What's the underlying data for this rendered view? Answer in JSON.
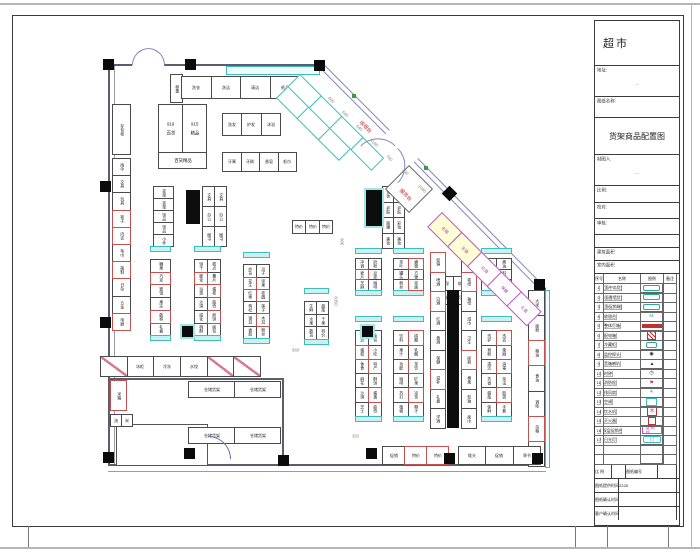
{
  "title_block": {
    "store_name": "超市",
    "address_label": "地址:",
    "address_value": "··",
    "sheet_name_label": "图纸名称:",
    "sheet_title": "货架商品配置图",
    "drafter_label": "制图人:",
    "drafter_value": "···",
    "scale_label": "比例:",
    "check_label": "校对:",
    "audit_label": "审核:",
    "area_label_1": "建筑面积",
    "area_label_2": "室内面积"
  },
  "legend": {
    "headers": [
      "序号",
      "名称",
      "图例",
      "备注"
    ],
    "rows": [
      {
        "no": "1",
        "name": "双面中岛货架",
        "sym": "teal-pill",
        "txt": ""
      },
      {
        "no": "2",
        "name": "单面靠墙货架",
        "sym": "teal-pill",
        "txt": ""
      },
      {
        "no": "3",
        "name": "双面促销端架",
        "sym": "teal-pill",
        "txt": ""
      },
      {
        "no": "4",
        "name": "收银台",
        "sym": "teal-text",
        "txt": "M"
      },
      {
        "no": "5",
        "name": "整体灯箱",
        "sym": "red-bar",
        "txt": ""
      },
      {
        "no": "6",
        "name": "配电箱",
        "sym": "red-box",
        "txt": ""
      },
      {
        "no": "7",
        "name": "冷藏柜",
        "sym": "teal-sm",
        "txt": ""
      },
      {
        "no": "8",
        "name": "监控探头",
        "sym": "cam",
        "txt": "◉"
      },
      {
        "no": "9",
        "name": "音箱喇叭",
        "sym": "tri",
        "txt": "▲"
      },
      {
        "no": "10",
        "name": "时钟",
        "sym": "clock",
        "txt": "◷"
      },
      {
        "no": "11",
        "name": "消防栓",
        "sym": "flag",
        "txt": "⚑"
      },
      {
        "no": "12",
        "name": "排风扇",
        "sym": "fan",
        "txt": "✳"
      },
      {
        "no": "13",
        "name": "空调",
        "sym": "cyan-box",
        "txt": ""
      },
      {
        "no": "14",
        "name": "饮水机",
        "sym": "red-water",
        "txt": "水"
      },
      {
        "no": "15",
        "name": "灭火器",
        "sym": "red-sm",
        "txt": ""
      },
      {
        "no": "16",
        "name": "双层促销台",
        "sym": "mag-box",
        "txt": "促销台"
      },
      {
        "no": "17",
        "name": "日光灯",
        "sym": "cyan-pill",
        "txt": "灯"
      },
      {
        "no": "",
        "name": "",
        "sym": "none",
        "txt": ""
      },
      {
        "no": "",
        "name": "",
        "sym": "none",
        "txt": ""
      }
    ]
  },
  "footer": {
    "row1": [
      "比 例",
      "",
      "图纸编号",
      ""
    ],
    "rows": [
      {
        "label": "图纸提供时间",
        "value": "2228"
      },
      {
        "label": "图纸确认时间",
        "value": ""
      },
      {
        "label": "客户确认时间",
        "value": ""
      }
    ]
  },
  "plan": {
    "labels": {
      "locker": "存包柜",
      "weigh": "称重",
      "cashier": "收银台",
      "service": "服务台"
    },
    "dims": [
      "600",
      "640",
      "640",
      "3180",
      "760",
      "130",
      "1080"
    ],
    "side_dims": [
      "900",
      "362",
      "3050",
      "960"
    ],
    "blk919": {
      "a_num": "919",
      "a_txt": "百货",
      "b_num": "915",
      "b_txt": "精品",
      "c": "百货精品"
    },
    "groups": {
      "lw": [
        "雨伞",
        "文具",
        "玩具",
        {
          "t": "袜子",
          "c": "r"
        },
        {
          "t": "内衣",
          "c": "r"
        },
        "毛巾",
        {
          "t": "拖鞋",
          "c": "r"
        },
        "日杂",
        "五金",
        {
          "t": "电器",
          "c": "r"
        }
      ],
      "h1": [
        "洗衣",
        "洗洁",
        "清洁",
        "纸品"
      ],
      "h2": [
        "洗发",
        "护发",
        "沐浴"
      ],
      "h3": [
        "牙膏",
        "牙刷",
        "香皂",
        "毛巾"
      ],
      "g1": [
        "挂架",
        "挂架",
        "饰品",
        "饰品",
        "小件"
      ],
      "g2": [
        "文具",
        "文具",
        "办公",
        "办公",
        "图书",
        "图书"
      ],
      "g4": [
        "化妆",
        "化妆",
        "护肤",
        "护肤",
        "面膜",
        "彩妆",
        "美妆",
        "美妆"
      ],
      "l1": [
        "糖果",
        {
          "t": "巧克",
          "c": "r"
        },
        "蜜饯",
        "果冻",
        {
          "t": "散称",
          "c": "r"
        },
        "礼盒"
      ],
      "l2": [
        "饼干",
        "糕点",
        {
          "t": "膨化",
          "c": "r"
        },
        "薯片",
        "派类",
        {
          "t": "蛋卷",
          "c": "r"
        },
        "沙琪",
        "曲奇",
        "威化",
        {
          "t": "煎饼",
          "c": "r"
        },
        "桃酥",
        "面包"
      ],
      "l3": [
        "炒货",
        "瓜子",
        {
          "t": "花生",
          "c": "r"
        },
        "坚果",
        "红枣",
        {
          "t": "桂圆",
          "c": "r"
        },
        "枸杞",
        "莲子",
        "银耳",
        {
          "t": "木耳",
          "c": "r"
        },
        "香菇",
        "粉丝"
      ],
      "s1": [
        "生鲜",
        "蔬菜",
        "水果",
        "干果",
        "散货",
        "特价"
      ],
      "t1": [
        "特价",
        "特价",
        "特价"
      ],
      "u1": [
        "冲调",
        "奶粉",
        {
          "t": "麦片",
          "c": "r"
        },
        "豆浆",
        "芝麻",
        "咖啡"
      ],
      "u2": [
        "茶叶",
        {
          "t": "蜂蜜",
          "c": "r"
        },
        "罐头",
        "方便",
        "粉丝",
        {
          "t": "挂面",
          "c": "r"
        }
      ],
      "u3": [
        "调味",
        "酱油",
        {
          "t": "醋类",
          "c": "r"
        },
        "料酒",
        "香料",
        "鸡精"
      ],
      "b22": [
        "劳保",
        "蚊香",
        "电池",
        "灯泡"
      ],
      "barl": [
        {
          "t": "促销",
          "c": "r"
        },
        "啤酒",
        {
          "t": "白酒",
          "c": "r"
        },
        "红酒",
        "黄酒",
        "保健",
        {
          "t": "滋补",
          "c": "r"
        },
        "礼盒",
        "洋酒"
      ],
      "barr": [
        "纸品",
        {
          "t": "卷纸",
          "c": "r"
        },
        "抽纸",
        "湿巾",
        "卫生",
        {
          "t": "尿裤",
          "c": "r"
        },
        "棉柔",
        "软抽",
        "面巾"
      ],
      "d1": [
        "糕点",
        "面包",
        {
          "t": "蛋糕",
          "c": "r"
        },
        "小吃",
        "休食",
        {
          "t": "特产",
          "c": "r"
        },
        "麻花",
        "酥饼",
        "沙琪",
        {
          "t": "蛋黄",
          "c": "r"
        },
        "芝士",
        "曲奇"
      ],
      "d2": [
        "饮料",
        {
          "t": "碳酸",
          "c": "r"
        },
        "果汁",
        "乳酸",
        "功能",
        {
          "t": "茶饮",
          "c": "r"
        },
        "咖啡",
        "矿泉",
        "苏打",
        {
          "t": "凉茶",
          "c": "r"
        },
        "植物",
        "椰汁"
      ],
      "d4": [
        "洗护",
        {
          "t": "洗衣",
          "c": "r"
        },
        "皂粉",
        "柔顺",
        "清洁",
        {
          "t": "消毒",
          "c": "r"
        },
        "芳香",
        "杀虫",
        "蜡烛",
        {
          "t": "胶袋",
          "c": "r"
        },
        "保鲜",
        "手套"
      ],
      "rw": [
        "大米",
        "面粉",
        {
          "t": "粮油",
          "c": "r"
        },
        "食油",
        "调味",
        {
          "t": "杂粮",
          "c": "r"
        },
        "鸡蛋"
      ],
      "br1": [
        "促销",
        {
          "t": "特价",
          "c": "r"
        },
        {
          "t": "特价",
          "c": "r"
        }
      ],
      "br2": [
        "堆头",
        "促销",
        "季节"
      ],
      "sl": [
        {
          "s": 1
        },
        {
          "t": "冰柜"
        },
        {
          "t": "冷冻"
        },
        {
          "t": "水饺"
        },
        {
          "s": 1
        },
        {
          "s": 1
        }
      ],
      "st1": [
        "仓储货架",
        "仓储货架"
      ],
      "st2": [
        "仓储货架",
        "仓储货架"
      ],
      "e1": [
        {
          "t": "米箱",
          "c": "r"
        }
      ],
      "e2": [
        "油",
        "米"
      ],
      "dg1a": [
        "",
        "",
        "",
        ""
      ],
      "dg1b": [
        "",
        "",
        ""
      ],
      "dg3": [
        {
          "t": "名烟",
          "c": "m",
          "y": 1
        },
        {
          "t": "名酒",
          "c": "m",
          "y": 1
        },
        {
          "t": "红酒",
          "c": "m"
        },
        {
          "t": "保健",
          "c": "m"
        },
        {
          "t": "礼盒",
          "c": "m"
        }
      ]
    }
  }
}
